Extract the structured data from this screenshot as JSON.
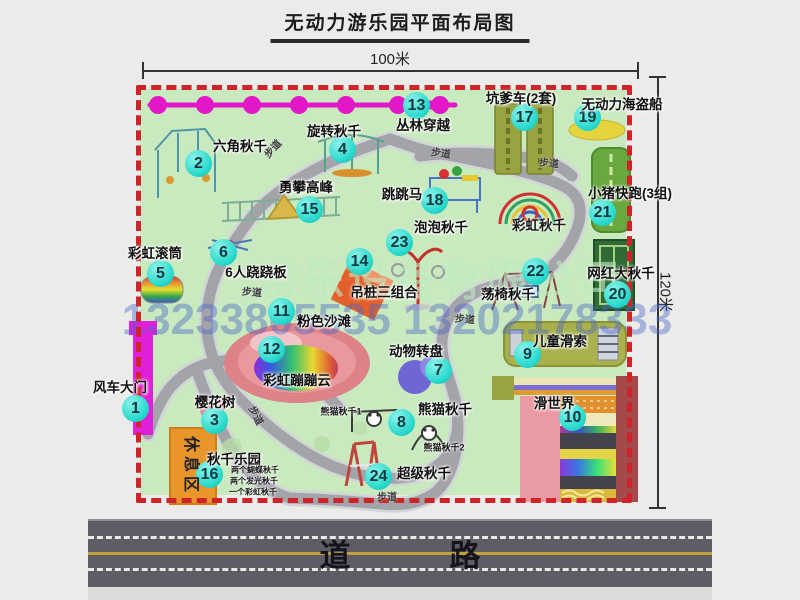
{
  "title": "无动力游乐园平面布局图",
  "dimensions": {
    "top": "100米",
    "right": "120米"
  },
  "road": {
    "label": "道　路"
  },
  "watermark": {
    "company": "游乐设备有限公司",
    "phone": "13233805535 13202178333"
  },
  "rest_area_label": "休息区",
  "attractions": [
    {
      "num": "1",
      "label": "风车大门",
      "cx": 136,
      "cy": 409,
      "lx": 120,
      "ly": 386
    },
    {
      "num": "2",
      "label": "六角秋千",
      "cx": 199,
      "cy": 164,
      "lx": 240,
      "ly": 145
    },
    {
      "num": "3",
      "label": "樱花树",
      "cx": 215,
      "cy": 421,
      "lx": 215,
      "ly": 401
    },
    {
      "num": "4",
      "label": "旋转秋千",
      "cx": 343,
      "cy": 150,
      "lx": 334,
      "ly": 130
    },
    {
      "num": "5",
      "label": "彩虹滚筒",
      "cx": 161,
      "cy": 274,
      "lx": 155,
      "ly": 252
    },
    {
      "num": "6",
      "label": "6人跷跷板",
      "cx": 224,
      "cy": 253,
      "lx": 256,
      "ly": 271
    },
    {
      "num": "7",
      "label": "动物转盘",
      "cx": 439,
      "cy": 371,
      "lx": 416,
      "ly": 350
    },
    {
      "num": "8",
      "label": "熊猫秋千",
      "cx": 402,
      "cy": 423,
      "lx": 445,
      "ly": 408
    },
    {
      "num": "9",
      "label": "儿童滑索",
      "cx": 528,
      "cy": 355,
      "lx": 560,
      "ly": 340
    },
    {
      "num": "10",
      "label": "滑世界",
      "cx": 573,
      "cy": 418,
      "lx": 554,
      "ly": 402
    },
    {
      "num": "11",
      "label": "粉色沙滩",
      "cx": 282,
      "cy": 312,
      "lx": 324,
      "ly": 320
    },
    {
      "num": "12",
      "label": "彩虹蹦蹦云",
      "cx": 272,
      "cy": 350,
      "lx": 297,
      "ly": 379
    },
    {
      "num": "13",
      "label": "丛林穿越",
      "cx": 417,
      "cy": 106,
      "lx": 423,
      "ly": 124
    },
    {
      "num": "14",
      "label": "吊桩三组合",
      "cx": 360,
      "cy": 262,
      "lx": 384,
      "ly": 291
    },
    {
      "num": "15",
      "label": "勇攀高峰",
      "cx": 310,
      "cy": 210,
      "lx": 306,
      "ly": 186
    },
    {
      "num": "16",
      "label": "秋千乐园",
      "cx": 210,
      "cy": 475,
      "lx": 234,
      "ly": 458
    },
    {
      "num": "17",
      "label": "坑爹车(2套)",
      "cx": 525,
      "cy": 118,
      "lx": 521,
      "ly": 97
    },
    {
      "num": "18",
      "label": "跳跳马",
      "cx": 435,
      "cy": 201,
      "lx": 402,
      "ly": 193
    },
    {
      "num": "19",
      "label": "无动力海盗船",
      "cx": 588,
      "cy": 118,
      "lx": 622,
      "ly": 103
    },
    {
      "num": "20",
      "label": "网红大秋千",
      "cx": 618,
      "cy": 295,
      "lx": 621,
      "ly": 272
    },
    {
      "num": "21",
      "label": "小猪快跑(3组)",
      "cx": 603,
      "cy": 213,
      "lx": 630,
      "ly": 192
    },
    {
      "num": "22",
      "label": "荡椅秋千",
      "cx": 536,
      "cy": 272,
      "lx": 508,
      "ly": 293
    },
    {
      "num": "23",
      "label": "泡泡秋千",
      "cx": 400,
      "cy": 243,
      "lx": 441,
      "ly": 226
    },
    {
      "num": "24",
      "label": "超级秋千",
      "cx": 379,
      "cy": 477,
      "lx": 424,
      "ly": 472
    }
  ],
  "extra_labels": [
    {
      "text": "彩虹秋千",
      "x": 539,
      "y": 224,
      "size": 13.5
    },
    {
      "text": "熊猫秋千1",
      "x": 341,
      "y": 411,
      "size": 9
    },
    {
      "text": "熊猫秋千2",
      "x": 444,
      "y": 447,
      "size": 9
    },
    {
      "text": "两个蝴蝶秋千",
      "x": 231,
      "y": 470,
      "size": 8,
      "align": "left"
    },
    {
      "text": "两个发光秋千",
      "x": 230,
      "y": 481,
      "size": 8,
      "align": "left"
    },
    {
      "text": "一个彩虹秋千",
      "x": 229,
      "y": 492,
      "size": 8,
      "align": "left"
    }
  ],
  "path_labels": [
    {
      "text": "步道",
      "x": 272,
      "y": 148,
      "rot": -48
    },
    {
      "text": "步道",
      "x": 441,
      "y": 152,
      "rot": 8
    },
    {
      "text": "步道",
      "x": 549,
      "y": 162,
      "rot": 5
    },
    {
      "text": "步道",
      "x": 252,
      "y": 291,
      "rot": 5
    },
    {
      "text": "步道",
      "x": 465,
      "y": 318,
      "rot": 5
    },
    {
      "text": "步道",
      "x": 257,
      "y": 415,
      "rot": 62
    },
    {
      "text": "步道",
      "x": 387,
      "y": 496,
      "rot": 0
    }
  ],
  "colors": {
    "park_green": "#c9e9be",
    "border_red": "#ce2328",
    "marker_teal": "#27d9cd",
    "path_gray": "#a3a3aa",
    "gate_magenta": "#e020d8",
    "road_gray": "#5d5d65",
    "rest_orange": "#e8952c"
  }
}
